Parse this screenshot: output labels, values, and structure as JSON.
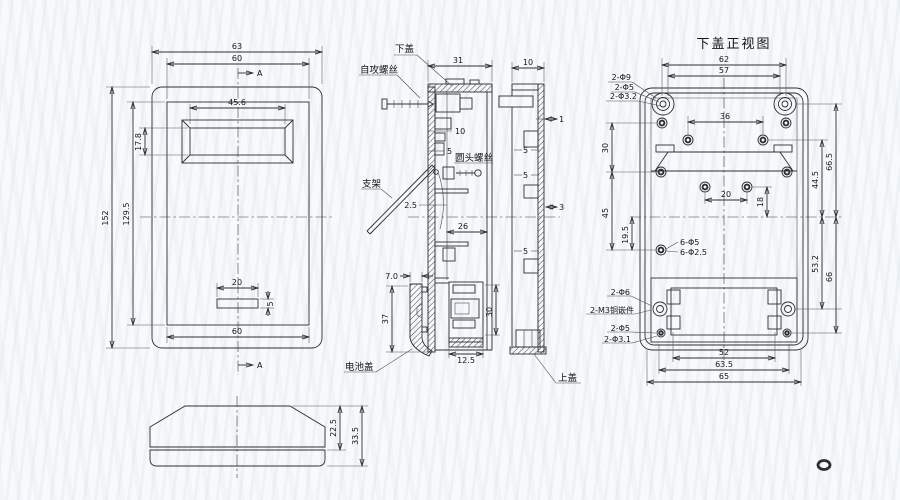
{
  "fv": {
    "d63": "63",
    "d60": "60",
    "d456": "45.6",
    "d178": "17.8",
    "d152": "152",
    "d1295": "129.5",
    "d20": "20",
    "d5": "5",
    "d60b": "60",
    "sec_a_top": "A",
    "sec_a_bottom": "A"
  },
  "pv": {
    "d225": "22.5",
    "d335": "33.5"
  },
  "sv": {
    "lower_cover": "下盖",
    "self_screw": "自攻螺丝",
    "round_screw": "圆头螺丝",
    "bracket": "支架",
    "battery_cover": "电池盖",
    "upper_cover": "上盖",
    "d31": "31",
    "d10": "10",
    "d5": "5",
    "d25": "2.5",
    "d26": "26",
    "d30": "30",
    "d125": "12.5",
    "d70": "7.0",
    "d37": "37",
    "u10": "10",
    "u1": "1",
    "u5a": "5",
    "u5b": "5",
    "u5c": "5",
    "u3": "3"
  },
  "bv": {
    "title": "下盖正视图",
    "d62": "62",
    "d57": "57",
    "d36": "36",
    "d20": "20",
    "d30": "30",
    "d45": "45",
    "d195": "19.5",
    "d18": "18",
    "d665": "66.5",
    "d445": "44.5",
    "d532": "53.2",
    "d66": "66",
    "d52": "52",
    "d635": "63.5",
    "d65": "65",
    "h_corner": "2-Φ9",
    "h_corner2": "2-Φ5",
    "h_corner3": "2-Φ3.2",
    "h_six": "6-Φ5",
    "h_six2": "6-Φ2.5",
    "h_b6": "2-Φ6",
    "h_m3": "2-M3铜嵌件",
    "h_b5": "2-Φ5",
    "h_b31": "2-Φ3.1"
  }
}
